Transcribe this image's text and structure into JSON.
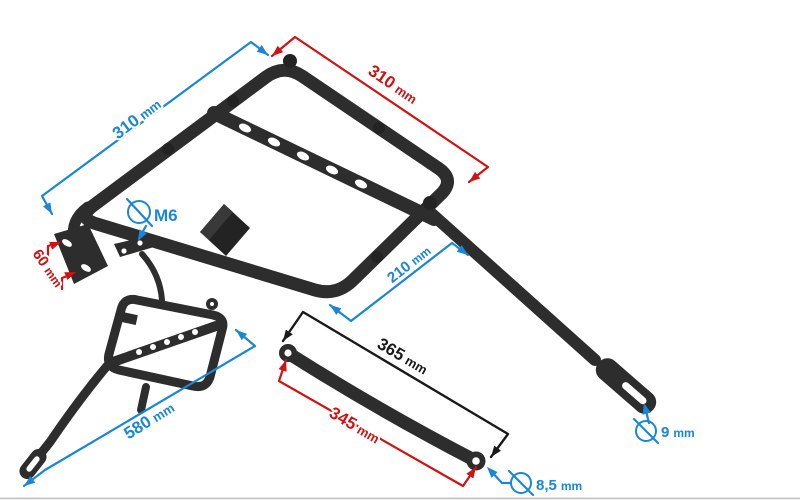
{
  "colors": {
    "blue": "#1b86d6",
    "red": "#d01212",
    "black": "#1a1a1a",
    "part": "#2d2d2d",
    "part_dark": "#232323"
  },
  "annotations": {
    "top_left_width": {
      "value": "310",
      "unit": "mm"
    },
    "top_right_width": {
      "value": "310",
      "unit": "mm"
    },
    "mount_plate_spacing": {
      "value": "60",
      "unit": "mm"
    },
    "thread_size": {
      "value": "M6"
    },
    "rear_arm_length": {
      "value": "210",
      "unit": "mm"
    },
    "side_frame_length": {
      "value": "580",
      "unit": "mm"
    },
    "strut_length_outer": {
      "value": "365",
      "unit": "mm"
    },
    "strut_length_inner": {
      "value": "345",
      "unit": "mm"
    },
    "arm_hole_diameter": {
      "value": "9",
      "unit": "mm"
    },
    "strut_hole_diameter": {
      "value": "8,5",
      "unit": "mm"
    }
  }
}
